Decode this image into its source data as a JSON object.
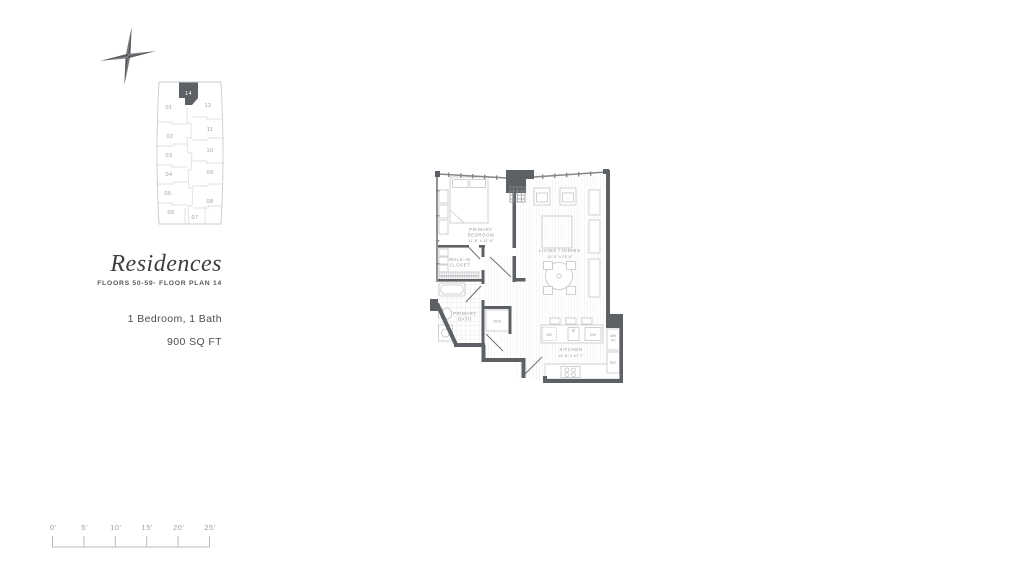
{
  "keyplan": {
    "units": [
      "01",
      "02",
      "03",
      "04",
      "05",
      "06",
      "07",
      "08",
      "09",
      "10",
      "11",
      "12"
    ],
    "highlighted_unit": "14",
    "highlight_color": "#5d6165"
  },
  "title_block": {
    "title": "Residences",
    "subtitle": "FLOORS 50-59- FLOOR PLAN 14"
  },
  "details": {
    "bed_bath": "1 Bedroom, 1 Bath",
    "area": "900 SQ FT"
  },
  "floor_plan": {
    "wall_color": "#5d6165",
    "rooms": {
      "primary_bedroom": {
        "line1": "PRIMARY",
        "line2": "BEDROOM",
        "dims": "11'-6\" x 12'-6\""
      },
      "walk_in_closet": {
        "line1": "WALK-IN",
        "line2": "CLOSET"
      },
      "primary_bath": {
        "line1": "PRIMARY",
        "line2": "BATH"
      },
      "living_dining": {
        "line1": "LIVING / DINING",
        "dims": "13'-9\" x 23'-9\""
      },
      "kitchen": {
        "line1": "KITCHEN",
        "dims": "10'-8\" x 10'-7\""
      }
    },
    "appliances": {
      "washer_dryer": "W/D",
      "wine_cooler": "WC",
      "dishwasher": "DW",
      "microwave_line1": "MW",
      "microwave_line2": "OV",
      "refrigerator": "REF"
    }
  },
  "scale_bar": {
    "labels": [
      "0'",
      "5'",
      "10'",
      "15'",
      "20'",
      "25'"
    ]
  }
}
